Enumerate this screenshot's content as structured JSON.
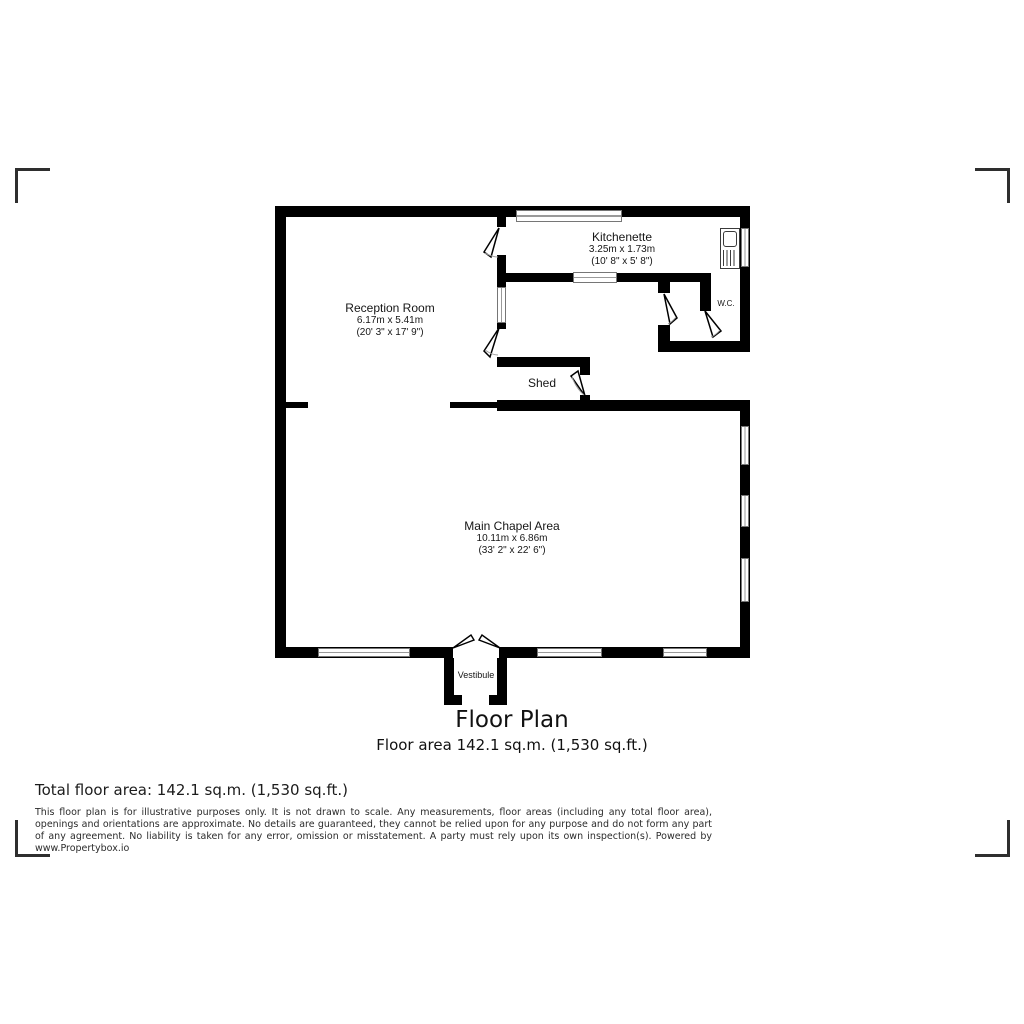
{
  "caption": {
    "title": "Floor Plan",
    "subtitle": "Floor area 142.1 sq.m. (1,530 sq.ft.)"
  },
  "rooms": [
    {
      "name": "Reception Room",
      "dims_metric": "6.17m x 5.41m",
      "dims_imperial": "(20' 3\" x 17' 9\")"
    },
    {
      "name": "Kitchenette",
      "dims_metric": "3.25m x 1.73m",
      "dims_imperial": "(10' 8\" x 5' 8\")"
    },
    {
      "name": "W.C."
    },
    {
      "name": "Shed"
    },
    {
      "name": "Main Chapel Area",
      "dims_metric": "10.11m x 6.86m",
      "dims_imperial": "(33' 2\" x 22' 6\")"
    },
    {
      "name": "Vestibule"
    }
  ],
  "footer": {
    "total_area": "Total floor area: 142.1 sq.m. (1,530 sq.ft.)",
    "disclaimer": "This floor plan is for illustrative purposes only. It is not drawn to scale. Any measurements, floor areas (including any total floor area), openings and orientations are approximate. No details are guaranteed, they cannot be relied upon for any purpose and do not form any part of any agreement. No liability is taken for any error, omission or misstatement. A party must rely upon its own inspection(s). Powered by www.Propertybox.io"
  },
  "colors": {
    "wall": "#000000",
    "crop_mark": "#2e2e2e",
    "text": "#161616"
  }
}
